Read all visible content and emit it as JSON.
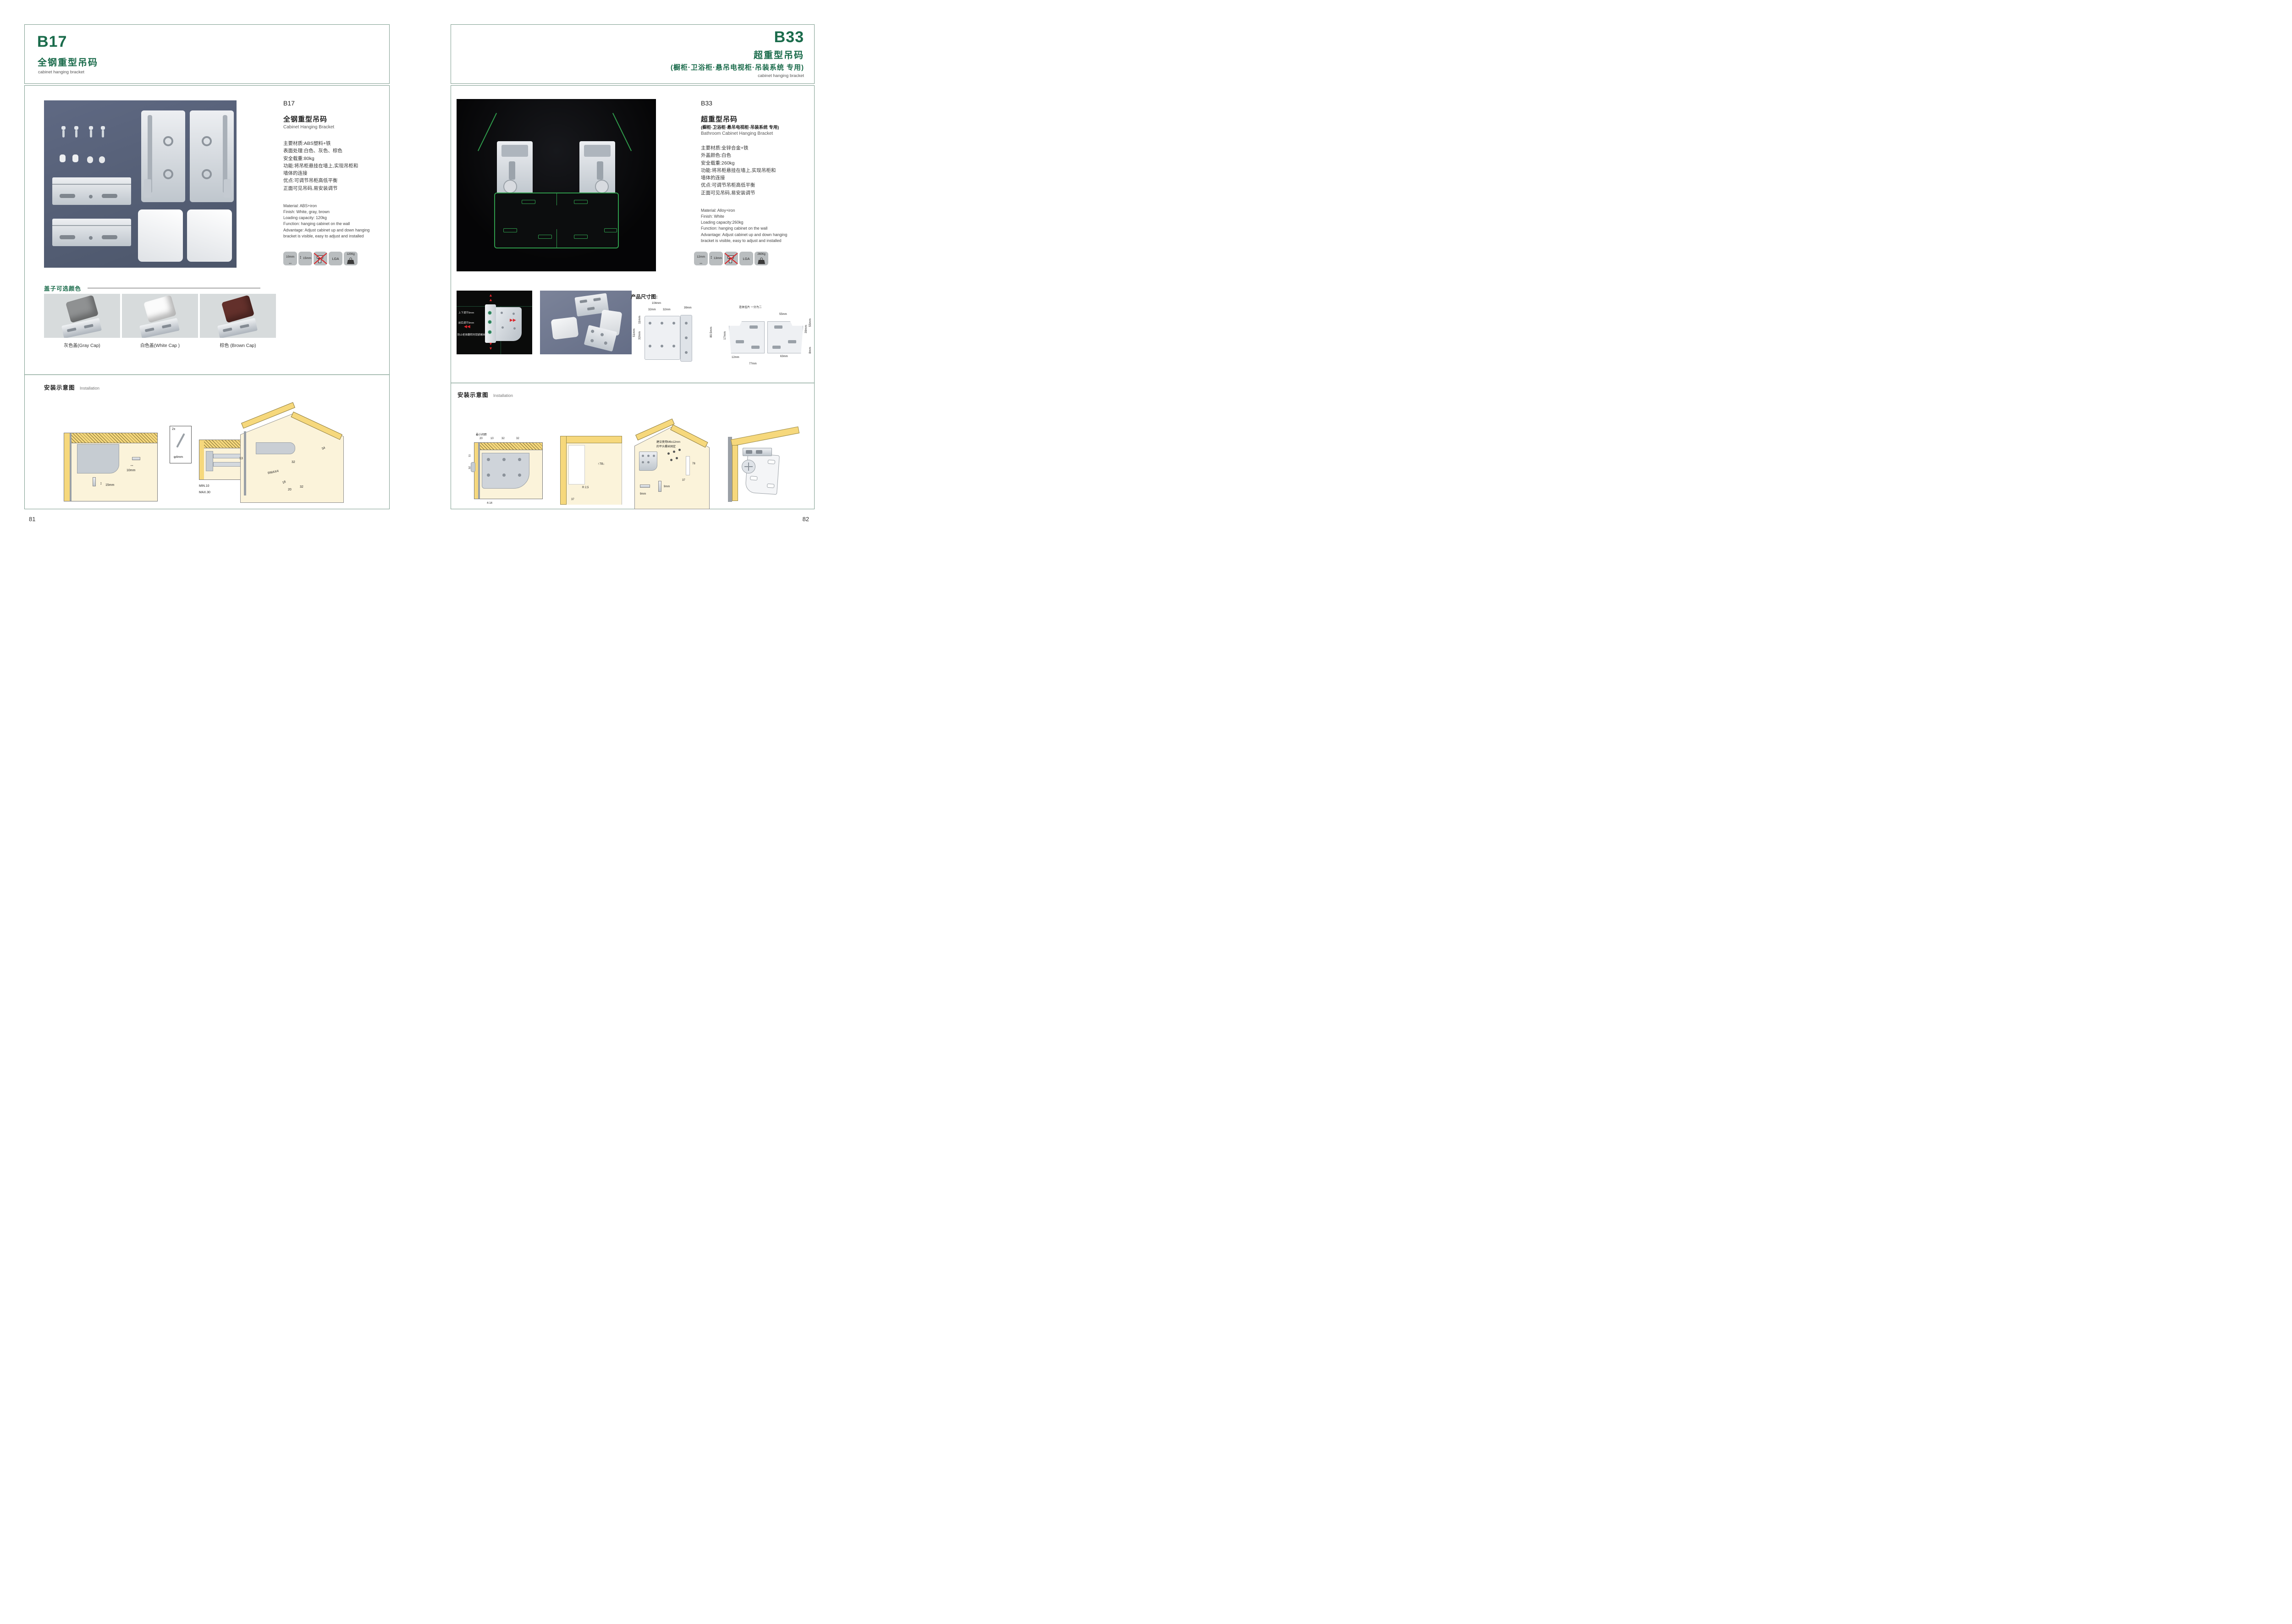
{
  "colors": {
    "green": "#1a6b4b",
    "border": "#7d9c8e",
    "red": "#d9252a",
    "wood": "#f6d87c",
    "cream": "#fbf3da",
    "wire": "#2f9b4b",
    "photo": "#59627a",
    "ink": "#333333"
  },
  "left": {
    "page_number": "81",
    "header": {
      "code": "B17",
      "title_cn": "全钢重型吊码",
      "subtitle_en": "cabinet hanging bracket"
    },
    "product": {
      "code": "B17",
      "name_cn": "全钢重型吊码",
      "name_en": "Cabinet Hanging Bracket",
      "specs_cn": [
        "主要材质:ABS塑料+铁",
        "表面处理:白色、灰色、棕色",
        "安全载重:80kg",
        "功能:将吊柜悬挂在墙上,实现吊柜和",
        "墙体的连接",
        "优点:可调节吊柜高低平衡",
        "正面可见吊码,易安装调节"
      ],
      "specs_en": [
        "Material: ABS+iron",
        "Finish: White, gray, brown",
        "Loading capacity: 120kg",
        "Function: hanging cabinet on the wall",
        "Advantage: Adjust cabinet up and down hanging",
        "bracket is visible, easy to adjust and installed"
      ]
    },
    "icons": {
      "width_label": "10mm",
      "height_label": "15mm",
      "cert_label": "LGA",
      "load_label": "120Kg"
    },
    "caps": {
      "title": "盖子可选颜色",
      "items": [
        {
          "label": "灰色盖(Gray Cap)",
          "color": "#8f9192"
        },
        {
          "label": "白色盖(White Cap )",
          "color": "#fbfbfb"
        },
        {
          "label": "棕色 (Brown Cap)",
          "color": "#63302b"
        }
      ]
    },
    "installation": {
      "title_cn": "安装示意图",
      "title_en": "Installation",
      "d1": {
        "dim_w": "10mm",
        "dim_h": "15mm"
      },
      "d2": {
        "qty": "2x",
        "screw": "φ4mm",
        "min": "MIN.10",
        "max": "MAX.30",
        "depth": "78"
      },
      "d3": {
        "back": "13",
        "top": "34",
        "v32": "32",
        "radius": "RMAX4",
        "w18": "18",
        "w20": "20",
        "w32": "32"
      }
    }
  },
  "right": {
    "page_number": "82",
    "header": {
      "code": "B33",
      "title_cn": "超重型吊码",
      "title_cn2": "(橱柜·卫浴柜·悬吊电视柜·吊装系统 专用)",
      "subtitle_en": "cabinet hanging bracket"
    },
    "product": {
      "code": "B33",
      "name_cn": "超重型吊码",
      "name_cn2": "(橱柜·卫浴柜·悬吊电视柜·吊装系统 专用)",
      "name_en": "Bathroom Cabinet Hanging Bracket",
      "specs_cn": [
        "主要材质:全锌合金+铁",
        "外盖颜色:白色",
        "安全载重:260kg",
        "功能:将吊柜悬挂在墙上,实现吊柜和",
        "墙体的连接",
        "优点:可调节吊柜高低平衡",
        "正面可见吊码,易安装调节"
      ],
      "specs_en": [
        "Material: Alloy+iron",
        "Finish: White",
        "Loading capacity:260kg",
        "Function: hanging cabinet on the wall",
        "Advantage: Adjust cabinet up and down hanging",
        "bracket is visible, easy to adjust and installed"
      ]
    },
    "icons": {
      "width_label": "12mm",
      "height_label": "13mm",
      "cert_label": "LGA",
      "load_label": "260Kg"
    },
    "annotations": [
      "上下调节9mm",
      "前后调节9mm",
      "防止柜体翻转的锁紧螺丝"
    ],
    "dims": {
      "title": "产品尺寸图:",
      "bracket": {
        "w104": "104mm",
        "w39": "39mm",
        "w32a": "32mm",
        "w32b": "32mm",
        "h11": "11mm",
        "h51": "51mm",
        "h32": "32mm",
        "h805": "80.5mm"
      },
      "plate": {
        "note": "连体挂片 一分为二",
        "w55": "55mm",
        "h55": "55mm",
        "h39": "39mm",
        "h17": "17mm",
        "h8": "8mm",
        "w12": "12mm",
        "w63": "63mm",
        "w77": "77mm"
      }
    },
    "installation": {
      "title_cn": "安装示意图",
      "title_en": "Installation",
      "d1": {
        "note": "最小间距",
        "d20": "20",
        "d10": "10",
        "d32a": "32",
        "d32b": "32",
        "h11": "11",
        "h32": "32",
        "gap": "4-14"
      },
      "d2": {
        "h78": "78",
        "r": "R 2,5",
        "w37": "37"
      },
      "d3": {
        "note1": "建议使用M6x12mm",
        "note2": "的平头螺丝固定",
        "h78": "78",
        "w37": "37",
        "s9a": "9mm",
        "s9b": "9mm"
      }
    }
  }
}
